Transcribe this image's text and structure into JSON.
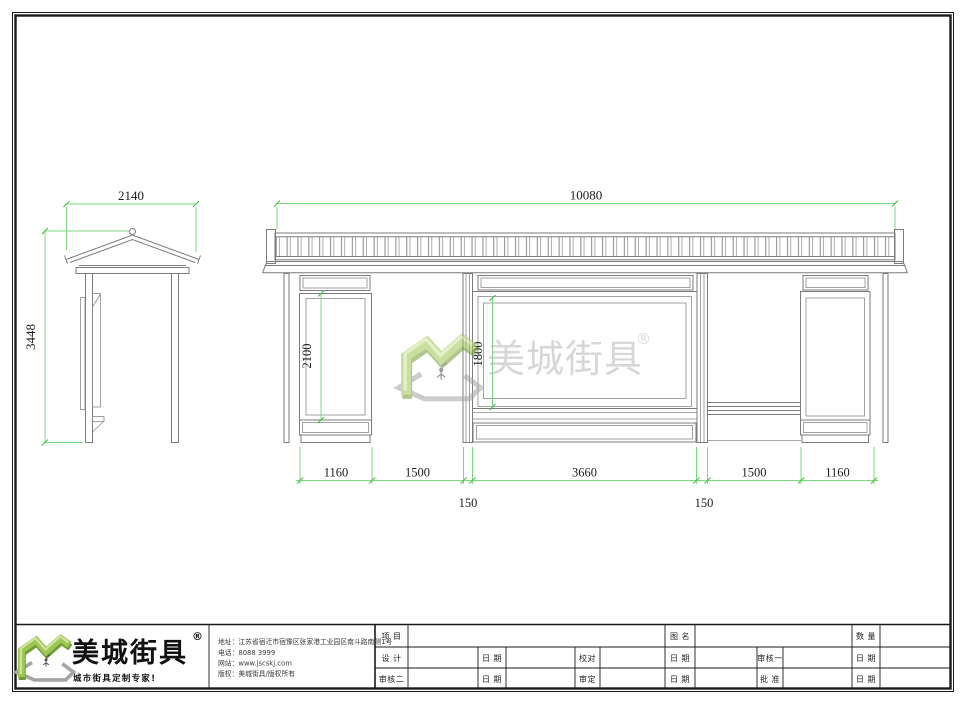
{
  "sheet": {
    "watermark": {
      "brand": "美城街具",
      "registered": "®"
    },
    "dimensions": {
      "side_width": "2140",
      "side_height": "3448",
      "front_total": "10080",
      "left_panel_height": "2100",
      "center_panel_height": "1800",
      "bottom_chain": [
        "1160",
        "1500",
        "3660",
        "1500",
        "1160"
      ],
      "post_widths": [
        "150",
        "150"
      ]
    },
    "title_block": {
      "brand": "美城街具",
      "registered": "®",
      "slogan": "城市街具定制专家!",
      "contact": {
        "address": "地址：江苏省宿迁市宿豫区张家港工业园区南斗路南侧1号",
        "phone": "电话：8088 3999",
        "website": "网站：www.jscskj.com",
        "copyright": "版权：美城街具/版权所有"
      },
      "table": {
        "project": "项 目",
        "drawing_name": "图 名",
        "quantity": "数 量",
        "design": "设 计",
        "check": "校对",
        "review1": "审核一",
        "review2": "审核二",
        "approve": "审定",
        "ratify": "批 准",
        "date": "日 期"
      }
    },
    "colors": {
      "dimension_green": "#7fd87f",
      "tick_green": "#49c349",
      "line_gray": "#7b7b7b",
      "logo_green_light": "#9dc653",
      "logo_green_dark": "#6f9c33",
      "logo_highlight": "#cfe49f",
      "logo_shadow": "#a6a6a6",
      "watermark_gray": "#b7b7b7"
    }
  }
}
